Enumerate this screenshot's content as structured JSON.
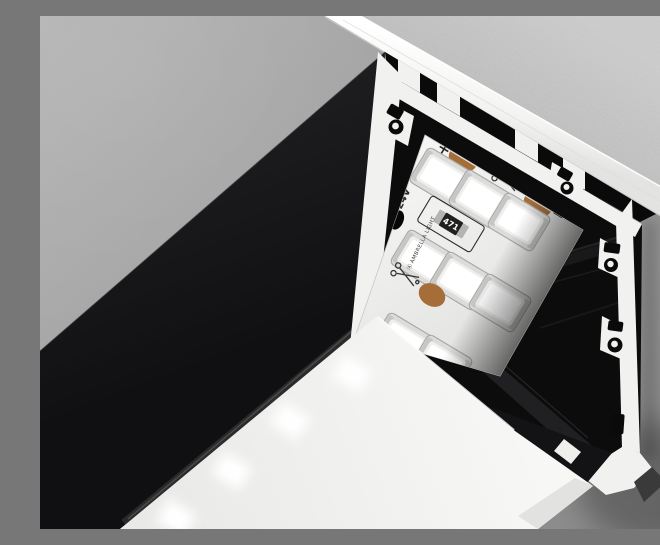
{
  "scene": {
    "type": "product-render",
    "subject": "Black surface-mounted aluminium LED profile on a concrete ceiling, cut open showing 24V LED strip and opal diffuser",
    "mount_surface": "concrete ceiling",
    "palette": {
      "wall": "#9c9c9c",
      "ceiling_concrete": "#b9b9b9",
      "flange_aluminium": "#f4f4f4",
      "profile_black": "#161618",
      "interior_black": "#0c0c0c",
      "cut_face_white": "#f1f1ef",
      "strip_pcb": "#f0f0ee",
      "led_chip": "#ffffff",
      "copper_pad": "#a56e39",
      "resistor_body": "#b6b4b1",
      "resistor_chip": "#202020",
      "silkscreen": "#2d2d2d",
      "diffuser": "#f3f3f1",
      "led_glow": "#ffffff"
    }
  },
  "led_strip": {
    "voltage_label": "24V",
    "polarity_plus_label": "+",
    "polarity_minus_label": "−",
    "resistor_marking": "471",
    "brand_logo": "Ⓐ",
    "brand_label": "AMBRELLA LIGHT",
    "visible_led_count": 8,
    "visible_copper_pad_count": 3,
    "cut_mark_count": 2
  },
  "icons": {
    "cut_mark": "scissors-cut-icon",
    "plus": "plus-polarity-icon",
    "minus": "minus-polarity-icon",
    "hook": "hook-slot-icon"
  }
}
